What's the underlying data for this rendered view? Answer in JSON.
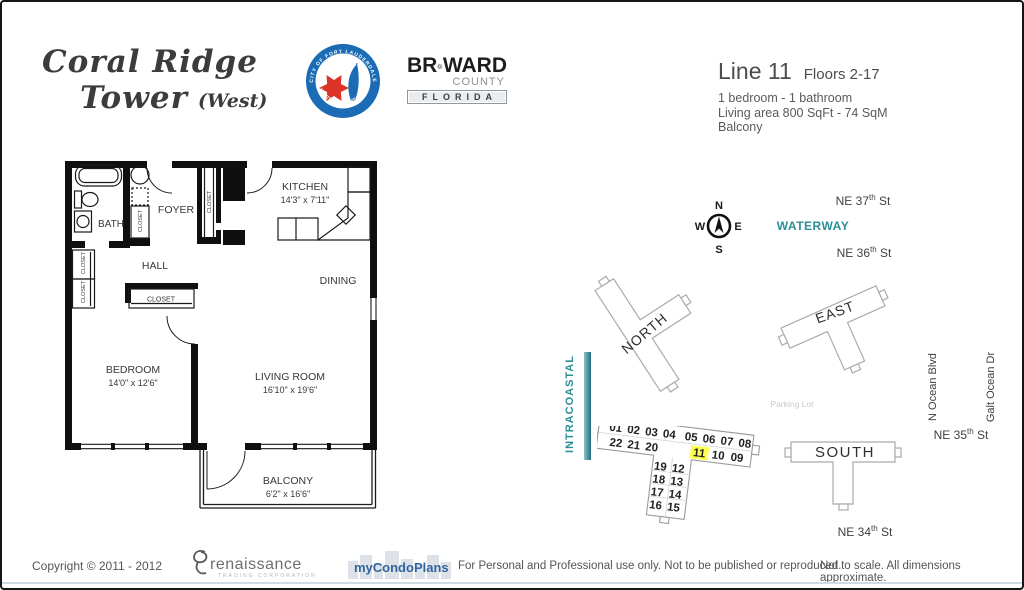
{
  "header": {
    "title_line1": "Coral Ridge",
    "title_line2": "Tower",
    "title_suffix": "(West)",
    "seal": {
      "top": "CITY OF FORT LAUDERDALE",
      "bottom": "VENICE OF AMERICA"
    },
    "broward": {
      "pre": "BR",
      "post": "WARD",
      "county": "COUNTY",
      "florida": "FLORIDA"
    },
    "unit": {
      "line_label": "Line 11",
      "floors": "Floors 2-17",
      "bed_bath": "1 bedroom - 1 bathroom",
      "living_area": "Living area  800  SqFt - 74 SqM",
      "balcony": "Balcony"
    }
  },
  "floorplan": {
    "kitchen": "KITCHEN",
    "kitchen_dims": "14'3\" x 7'11\"",
    "foyer": "FOYER",
    "bath": "BATH",
    "hall": "HALL",
    "dining": "DINING",
    "bedroom": "BEDROOM",
    "bedroom_dims": "14'0\" x 12'6\"",
    "living": "LIVING ROOM",
    "living_dims": "16'10\" x 19'6\"",
    "balcony": "BALCONY",
    "balcony_dims": "6'2\" x 16'6\"",
    "closet": "CLOSET"
  },
  "sitemap": {
    "compass": {
      "n": "N",
      "e": "E",
      "s": "S",
      "w": "W"
    },
    "waterway": "WATERWAY",
    "intracoastal": "INTRACOASTAL",
    "parking": "Parking Lot",
    "streets": {
      "ne37": {
        "pre": "NE 37",
        "sup": "th",
        "post": " St"
      },
      "ne36": {
        "pre": "NE 36",
        "sup": "th",
        "post": " St"
      },
      "ne35": {
        "pre": "NE 35",
        "sup": "th",
        "post": " St"
      },
      "ne34": {
        "pre": "NE 34",
        "sup": "th",
        "post": " St"
      },
      "n_ocean": "N Ocean Blvd",
      "galt_ocean": "Galt Ocean Dr"
    },
    "buildings": {
      "north": "NORTH",
      "east": "EAST",
      "south": "SOUTH"
    },
    "west_units": {
      "row1": [
        "01",
        "02",
        "03",
        "04",
        "05",
        "06",
        "07",
        "08"
      ],
      "row2_left": [
        "22",
        "21",
        "20"
      ],
      "row2_right": [
        "11",
        "10",
        "09"
      ],
      "stem": [
        [
          "19",
          "12"
        ],
        [
          "18",
          "13"
        ],
        [
          "17",
          "14"
        ],
        [
          "16",
          "15"
        ]
      ],
      "highlighted_unit": "11",
      "highlight_color": "#ffff4f"
    }
  },
  "footer": {
    "copyright": "Copyright © 2011 - 2012",
    "renaissance": "renaissance",
    "renaissance_sub": "TRADING CORPORATION",
    "mycondoplans": "myCondoPlans",
    "usage": "For Personal and Professional use only.  Not to be published or reproduced.",
    "disclaimer": "Not to scale.  All dimensions approximate."
  },
  "colors": {
    "teal": "#2b8f96",
    "seal_blue": "#1b6cb5",
    "seal_red": "#dd3327",
    "condo_blue": "#33639c",
    "highlight": "#ffff4f"
  }
}
